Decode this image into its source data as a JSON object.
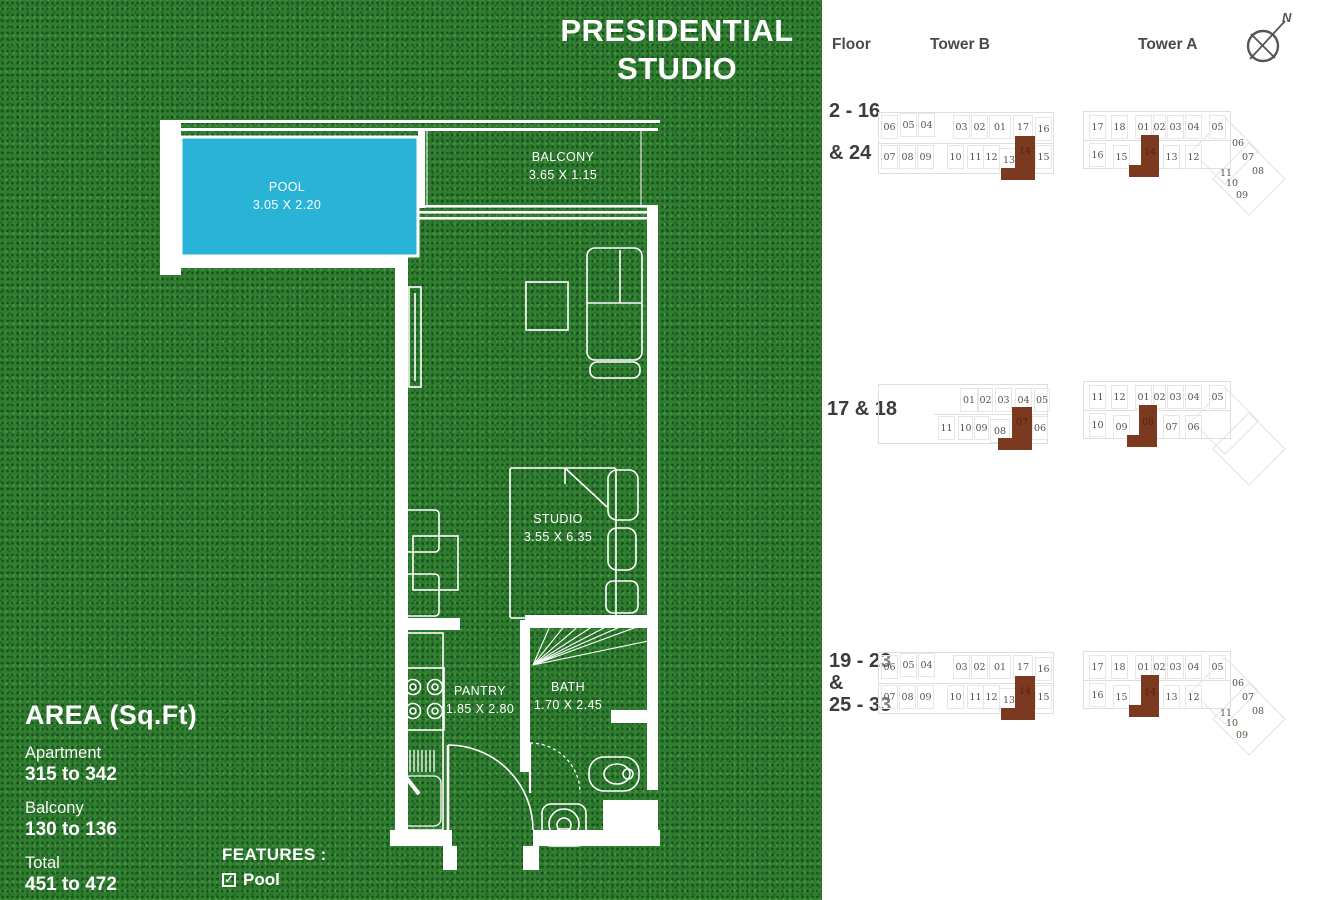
{
  "title": {
    "line1": "PRESIDENTIAL",
    "line2": "STUDIO"
  },
  "plan": {
    "rooms": [
      {
        "name": "POOL",
        "dims": "3.05 X 2.20"
      },
      {
        "name": "BALCONY",
        "dims": "3.65 X 1.15"
      },
      {
        "name": "STUDIO",
        "dims": "3.55 X 6.35"
      },
      {
        "name": "PANTRY",
        "dims": "1.85 X 2.80"
      },
      {
        "name": "BATH",
        "dims": "1.70 X 2.45"
      }
    ]
  },
  "area": {
    "heading": "AREA (Sq.Ft)",
    "items": [
      {
        "label": "Apartment",
        "value": "315 to 342"
      },
      {
        "label": "Balcony",
        "value": "130 to 136"
      },
      {
        "label": "Total",
        "value": "451 to 472"
      }
    ]
  },
  "features": {
    "heading": "FEATURES :",
    "items": [
      {
        "checked": true,
        "label": "Pool"
      }
    ]
  },
  "colors": {
    "grass": "#2e7d30",
    "pool": "#29b4d7",
    "wall": "#ffffff",
    "highlight": "#7b3a20",
    "heading_text": "#4a4a4a",
    "floor_text": "#3c3c3c",
    "unit_text": "#5d5146"
  },
  "key_panel": {
    "headers": {
      "floor": "Floor",
      "tower_b": "Tower B",
      "tower_a": "Tower A"
    },
    "compass_label": "N",
    "rows": [
      {
        "floor": {
          "x": 7,
          "y": 100,
          "lh": 42,
          "lines": [
            "2 - 16",
            "& 24"
          ]
        },
        "plans": [
          {
            "name": "tower-b-keyplan-floors-2-16-24",
            "pos": {
              "x": 56,
              "y": 108,
              "w": 180,
              "h": 90
            },
            "outline": [
              {
                "x": 0,
                "y": 4,
                "w": 176,
                "h": 62
              }
            ],
            "lines": [
              {
                "x": 0,
                "y": 35,
                "w": 176
              }
            ],
            "units": [
              {
                "t": "06",
                "x": 3,
                "y": 7
              },
              {
                "t": "05",
                "x": 22,
                "y": 5
              },
              {
                "t": "04",
                "x": 40,
                "y": 5
              },
              {
                "t": "03",
                "x": 75,
                "y": 7
              },
              {
                "t": "02",
                "x": 93,
                "y": 7
              },
              {
                "t": "01",
                "x": 111,
                "y": 7,
                "w": 22
              },
              {
                "t": "17",
                "x": 135,
                "y": 7,
                "w": 20
              },
              {
                "t": "16",
                "x": 157,
                "y": 9,
                "w": 17
              },
              {
                "t": "07",
                "x": 3,
                "y": 37
              },
              {
                "t": "08",
                "x": 21,
                "y": 37
              },
              {
                "t": "09",
                "x": 39,
                "y": 37
              },
              {
                "t": "10",
                "x": 69,
                "y": 37
              },
              {
                "t": "11",
                "x": 89,
                "y": 37
              },
              {
                "t": "12",
                "x": 105,
                "y": 37
              },
              {
                "t": "13",
                "x": 121,
                "y": 40,
                "w": 20
              },
              {
                "t": "15",
                "x": 157,
                "y": 37,
                "w": 17
              }
            ],
            "hl": [
              {
                "x": 137,
                "y": 28,
                "w": 20,
                "h": 44
              },
              {
                "x": 123,
                "y": 60,
                "w": 14,
                "h": 12
              }
            ],
            "hl_label": {
              "t": "14",
              "x": 137,
              "y": 34,
              "w": 20,
              "h": 18
            }
          },
          {
            "name": "tower-a-keyplan-floors-2-16-24",
            "pos": {
              "x": 261,
              "y": 105,
              "w": 196,
              "h": 140
            },
            "outline": [
              {
                "x": 0,
                "y": 6,
                "w": 148,
                "h": 58
              }
            ],
            "lines": [
              {
                "x": 0,
                "y": 35,
                "w": 148
              }
            ],
            "wings": [
              {
                "x": 118,
                "y": 22,
                "w": 48,
                "h": 48
              },
              {
                "x": 140,
                "y": 48,
                "w": 52,
                "h": 52
              }
            ],
            "units": [
              {
                "t": "17",
                "x": 6,
                "y": 10
              },
              {
                "t": "18",
                "x": 28,
                "y": 10
              },
              {
                "t": "01",
                "x": 52,
                "y": 10
              },
              {
                "t": "02",
                "x": 70,
                "y": 10,
                "w": 13
              },
              {
                "t": "03",
                "x": 84,
                "y": 10
              },
              {
                "t": "04",
                "x": 102,
                "y": 10
              },
              {
                "t": "05",
                "x": 126,
                "y": 10
              },
              {
                "t": "16",
                "x": 6,
                "y": 38
              },
              {
                "t": "15",
                "x": 30,
                "y": 40
              },
              {
                "t": "13",
                "x": 80,
                "y": 40
              },
              {
                "t": "12",
                "x": 102,
                "y": 40
              },
              {
                "t": "06",
                "x": 148,
                "y": 32,
                "w": 14,
                "h": 12,
                "nb": true
              },
              {
                "t": "07",
                "x": 158,
                "y": 46,
                "w": 14,
                "h": 12,
                "nb": true
              },
              {
                "t": "08",
                "x": 168,
                "y": 60,
                "w": 14,
                "h": 12,
                "nb": true
              },
              {
                "t": "11",
                "x": 136,
                "y": 62,
                "w": 14,
                "h": 12,
                "nb": true
              },
              {
                "t": "10",
                "x": 142,
                "y": 72,
                "w": 14,
                "h": 12,
                "nb": true
              },
              {
                "t": "09",
                "x": 152,
                "y": 84,
                "w": 14,
                "h": 12,
                "nb": true
              }
            ],
            "hl": [
              {
                "x": 58,
                "y": 30,
                "w": 18,
                "h": 42
              },
              {
                "x": 46,
                "y": 60,
                "w": 12,
                "h": 12
              }
            ],
            "hl_label": {
              "t": "14",
              "x": 58,
              "y": 38,
              "w": 18,
              "h": 18
            }
          }
        ]
      },
      {
        "floor": {
          "x": 5,
          "y": 398,
          "lh": 24,
          "lines": [
            "17 & 18"
          ]
        },
        "plans": [
          {
            "name": "tower-b-keyplan-floors-17-18",
            "pos": {
              "x": 56,
              "y": 380,
              "w": 180,
              "h": 90
            },
            "outline": [
              {
                "x": 0,
                "y": 4,
                "w": 170,
                "h": 60
              }
            ],
            "lines": [
              {
                "x": 56,
                "y": 34,
                "w": 114
              }
            ],
            "units": [
              {
                "t": "01",
                "x": 82,
                "y": 8,
                "w": 18
              },
              {
                "t": "02",
                "x": 100,
                "y": 8,
                "w": 15
              },
              {
                "t": "03",
                "x": 117,
                "y": 8
              },
              {
                "t": "04",
                "x": 137,
                "y": 8
              },
              {
                "t": "05",
                "x": 156,
                "y": 8,
                "w": 16
              },
              {
                "t": "11",
                "x": 60,
                "y": 36
              },
              {
                "t": "10",
                "x": 80,
                "y": 36,
                "w": 15
              },
              {
                "t": "09",
                "x": 96,
                "y": 36,
                "w": 15
              },
              {
                "t": "08",
                "x": 112,
                "y": 39,
                "w": 20
              },
              {
                "t": "06",
                "x": 154,
                "y": 36,
                "w": 16
              }
            ],
            "hl": [
              {
                "x": 134,
                "y": 27,
                "w": 20,
                "h": 43
              },
              {
                "x": 120,
                "y": 58,
                "w": 14,
                "h": 12
              }
            ],
            "hl_label": {
              "t": "07",
              "x": 134,
              "y": 33,
              "w": 20,
              "h": 18
            }
          },
          {
            "name": "tower-a-keyplan-floors-17-18",
            "pos": {
              "x": 261,
              "y": 375,
              "w": 196,
              "h": 140
            },
            "outline": [
              {
                "x": 0,
                "y": 6,
                "w": 148,
                "h": 58
              }
            ],
            "lines": [
              {
                "x": 0,
                "y": 35,
                "w": 148
              }
            ],
            "wings": [
              {
                "x": 118,
                "y": 22,
                "w": 48,
                "h": 48
              },
              {
                "x": 140,
                "y": 48,
                "w": 52,
                "h": 52
              }
            ],
            "units": [
              {
                "t": "11",
                "x": 6,
                "y": 10
              },
              {
                "t": "12",
                "x": 28,
                "y": 10
              },
              {
                "t": "01",
                "x": 52,
                "y": 10
              },
              {
                "t": "02",
                "x": 70,
                "y": 10,
                "w": 13
              },
              {
                "t": "03",
                "x": 84,
                "y": 10
              },
              {
                "t": "04",
                "x": 102,
                "y": 10
              },
              {
                "t": "05",
                "x": 126,
                "y": 10
              },
              {
                "t": "10",
                "x": 6,
                "y": 38
              },
              {
                "t": "09",
                "x": 30,
                "y": 40
              },
              {
                "t": "07",
                "x": 80,
                "y": 40
              },
              {
                "t": "06",
                "x": 102,
                "y": 40
              }
            ],
            "hl": [
              {
                "x": 56,
                "y": 30,
                "w": 18,
                "h": 42
              },
              {
                "x": 44,
                "y": 60,
                "w": 12,
                "h": 12
              }
            ],
            "hl_label": {
              "t": "08",
              "x": 56,
              "y": 38,
              "w": 18,
              "h": 18
            }
          }
        ]
      },
      {
        "floor": {
          "x": 7,
          "y": 650,
          "lh": 22,
          "lines": [
            "19 - 23",
            "&",
            "25 - 33"
          ]
        },
        "plans": [
          {
            "name": "tower-b-keyplan-floors-19-23-25-33",
            "pos": {
              "x": 56,
              "y": 648,
              "w": 180,
              "h": 90
            },
            "outline": [
              {
                "x": 0,
                "y": 4,
                "w": 176,
                "h": 62
              }
            ],
            "lines": [
              {
                "x": 0,
                "y": 35,
                "w": 176
              }
            ],
            "units": [
              {
                "t": "06",
                "x": 3,
                "y": 7
              },
              {
                "t": "05",
                "x": 22,
                "y": 5
              },
              {
                "t": "04",
                "x": 40,
                "y": 5
              },
              {
                "t": "03",
                "x": 75,
                "y": 7
              },
              {
                "t": "02",
                "x": 93,
                "y": 7
              },
              {
                "t": "01",
                "x": 111,
                "y": 7,
                "w": 22
              },
              {
                "t": "17",
                "x": 135,
                "y": 7,
                "w": 20
              },
              {
                "t": "16",
                "x": 157,
                "y": 9,
                "w": 17
              },
              {
                "t": "07",
                "x": 3,
                "y": 37
              },
              {
                "t": "08",
                "x": 21,
                "y": 37
              },
              {
                "t": "09",
                "x": 39,
                "y": 37
              },
              {
                "t": "10",
                "x": 69,
                "y": 37
              },
              {
                "t": "11",
                "x": 89,
                "y": 37
              },
              {
                "t": "12",
                "x": 105,
                "y": 37
              },
              {
                "t": "13",
                "x": 121,
                "y": 40,
                "w": 20
              },
              {
                "t": "15",
                "x": 157,
                "y": 37,
                "w": 17
              }
            ],
            "hl": [
              {
                "x": 137,
                "y": 28,
                "w": 20,
                "h": 44
              },
              {
                "x": 123,
                "y": 60,
                "w": 14,
                "h": 12
              }
            ],
            "hl_label": {
              "t": "14",
              "x": 137,
              "y": 34,
              "w": 20,
              "h": 18
            }
          },
          {
            "name": "tower-a-keyplan-floors-19-23-25-33",
            "pos": {
              "x": 261,
              "y": 645,
              "w": 196,
              "h": 140
            },
            "outline": [
              {
                "x": 0,
                "y": 6,
                "w": 148,
                "h": 58
              }
            ],
            "lines": [
              {
                "x": 0,
                "y": 35,
                "w": 148
              }
            ],
            "wings": [
              {
                "x": 118,
                "y": 22,
                "w": 48,
                "h": 48
              },
              {
                "x": 140,
                "y": 48,
                "w": 52,
                "h": 52
              }
            ],
            "units": [
              {
                "t": "17",
                "x": 6,
                "y": 10
              },
              {
                "t": "18",
                "x": 28,
                "y": 10
              },
              {
                "t": "01",
                "x": 52,
                "y": 10
              },
              {
                "t": "02",
                "x": 70,
                "y": 10,
                "w": 13
              },
              {
                "t": "03",
                "x": 84,
                "y": 10
              },
              {
                "t": "04",
                "x": 102,
                "y": 10
              },
              {
                "t": "05",
                "x": 126,
                "y": 10
              },
              {
                "t": "16",
                "x": 6,
                "y": 38
              },
              {
                "t": "15",
                "x": 30,
                "y": 40
              },
              {
                "t": "13",
                "x": 80,
                "y": 40
              },
              {
                "t": "12",
                "x": 102,
                "y": 40
              },
              {
                "t": "06",
                "x": 148,
                "y": 32,
                "w": 14,
                "h": 12,
                "nb": true
              },
              {
                "t": "07",
                "x": 158,
                "y": 46,
                "w": 14,
                "h": 12,
                "nb": true
              },
              {
                "t": "08",
                "x": 168,
                "y": 60,
                "w": 14,
                "h": 12,
                "nb": true
              },
              {
                "t": "11",
                "x": 136,
                "y": 62,
                "w": 14,
                "h": 12,
                "nb": true
              },
              {
                "t": "10",
                "x": 142,
                "y": 72,
                "w": 14,
                "h": 12,
                "nb": true
              },
              {
                "t": "09",
                "x": 152,
                "y": 84,
                "w": 14,
                "h": 12,
                "nb": true
              }
            ],
            "hl": [
              {
                "x": 58,
                "y": 30,
                "w": 18,
                "h": 42
              },
              {
                "x": 46,
                "y": 60,
                "w": 12,
                "h": 12
              }
            ],
            "hl_label": {
              "t": "14",
              "x": 58,
              "y": 38,
              "w": 18,
              "h": 18
            }
          }
        ]
      }
    ]
  }
}
